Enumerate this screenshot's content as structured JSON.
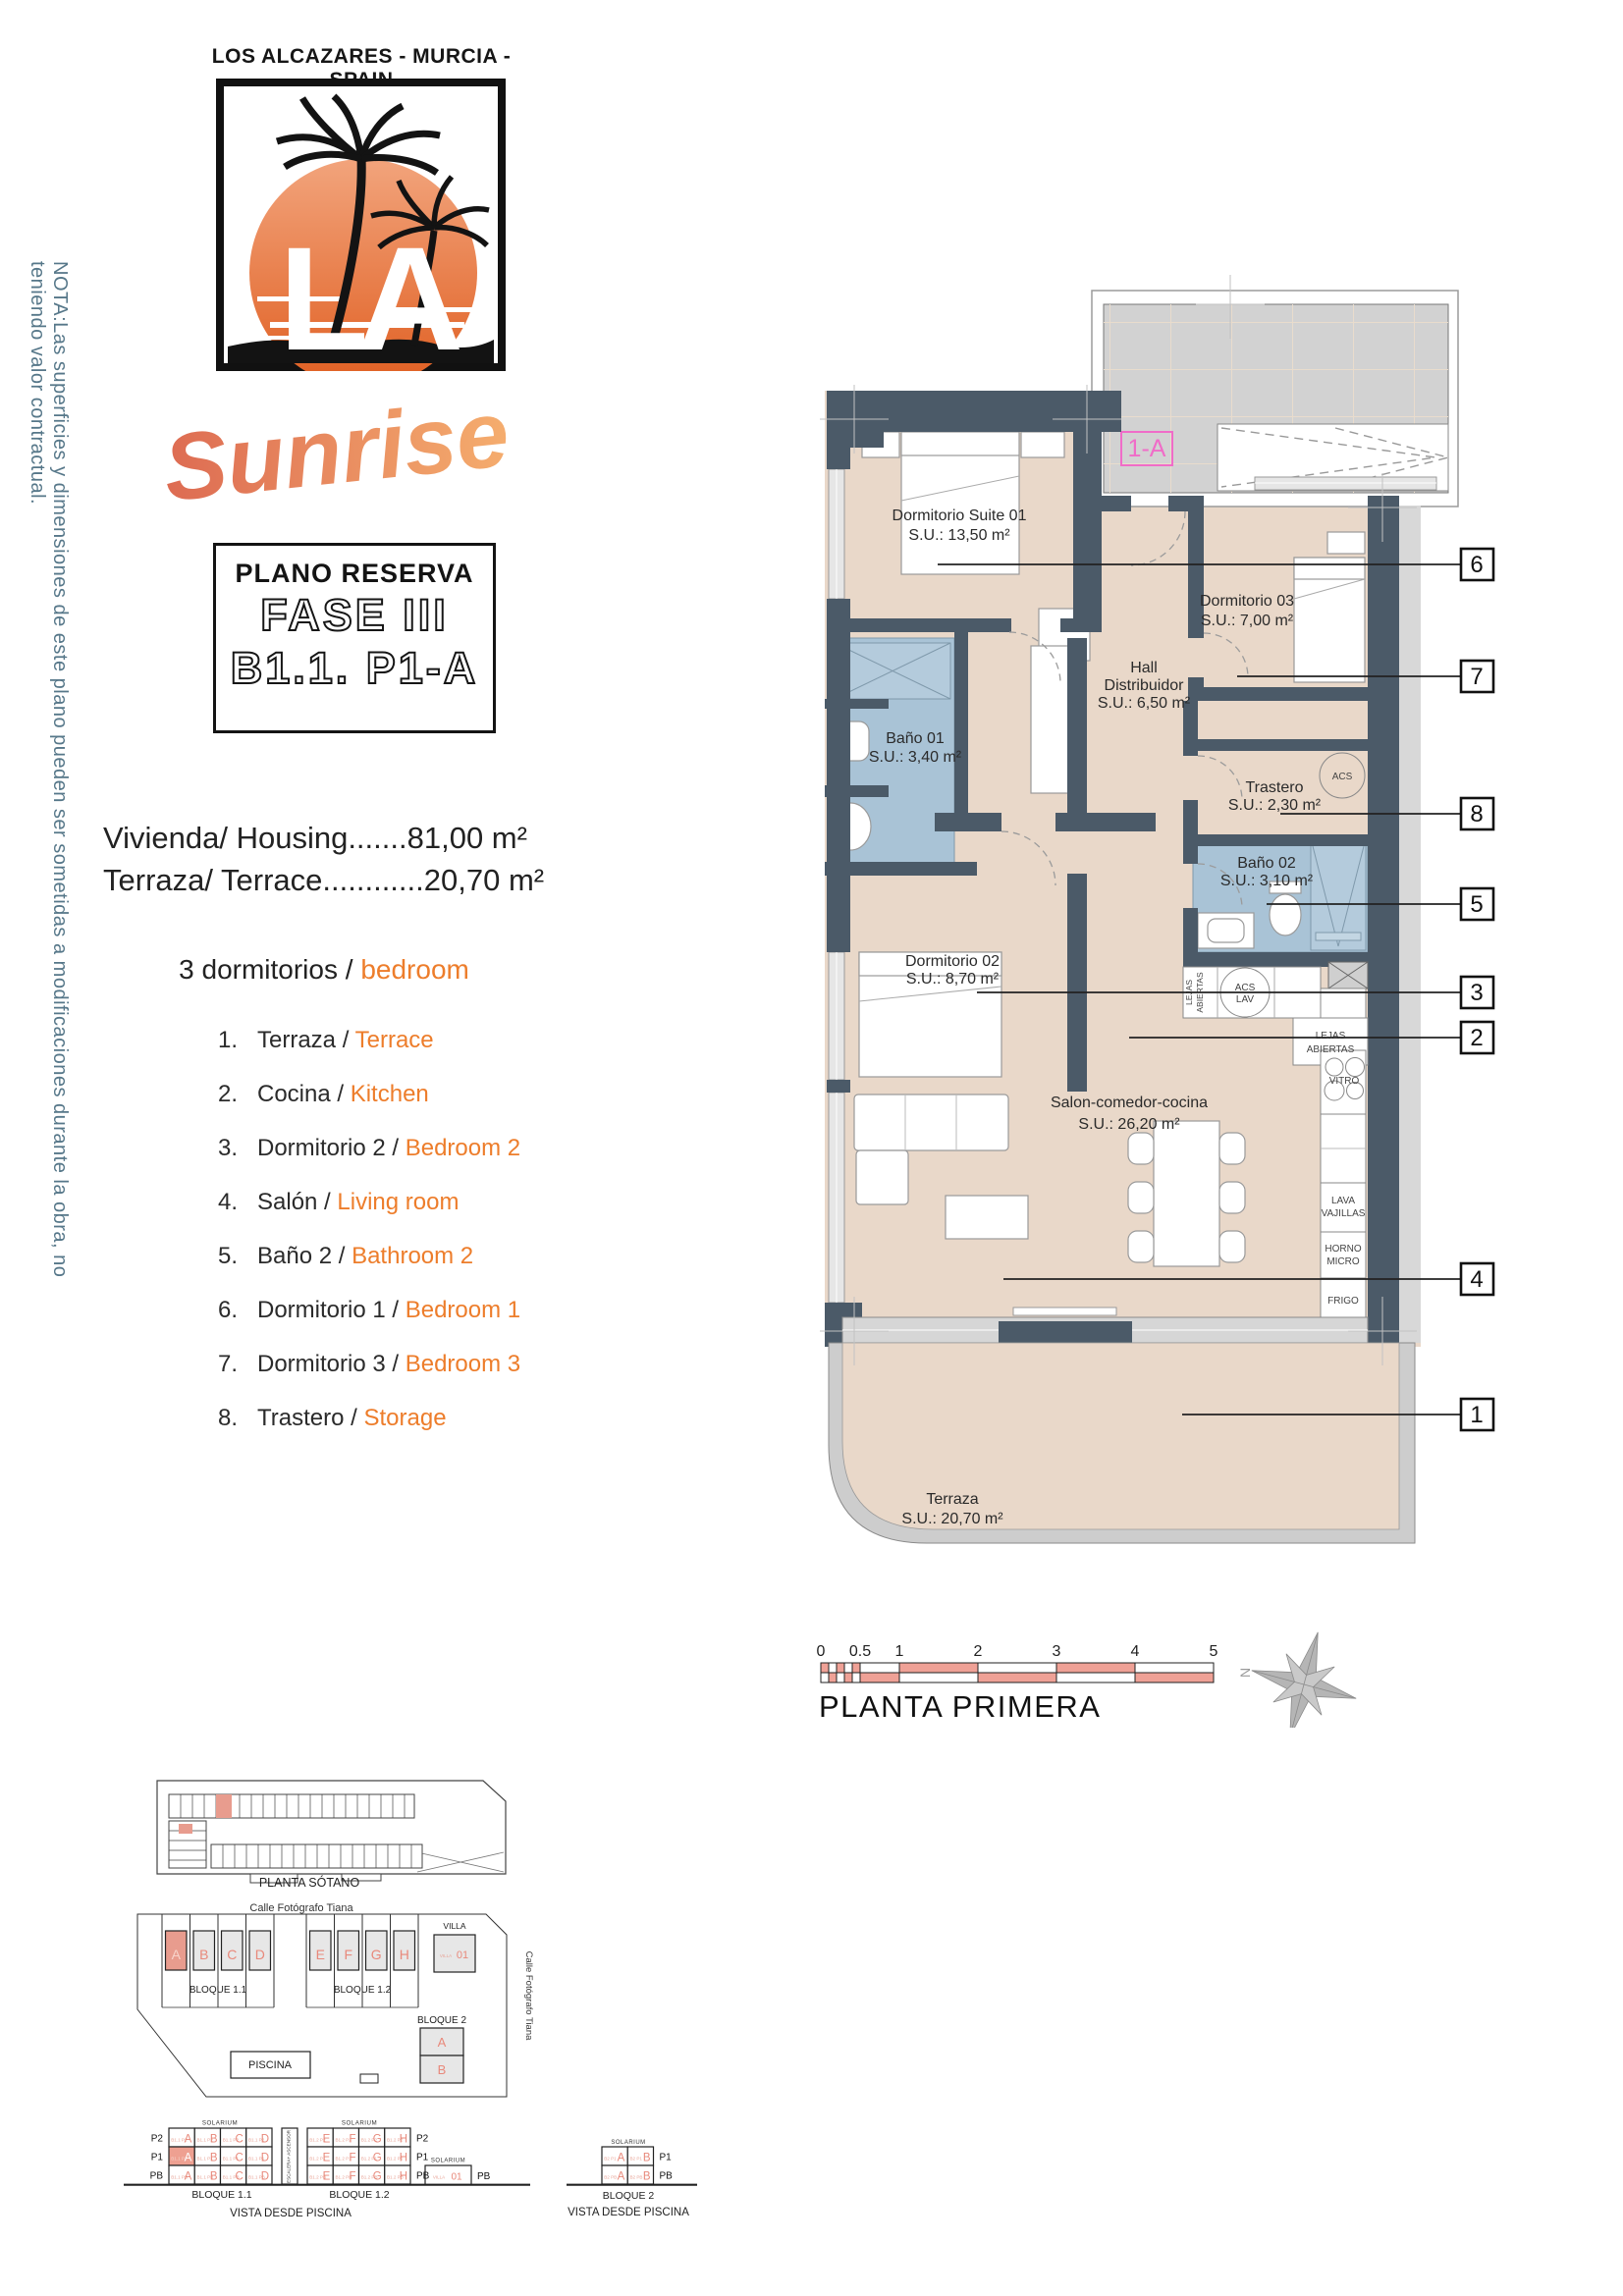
{
  "branding": {
    "location": "LOS ALCAZARES - MURCIA - SPAIN",
    "logo_monogram": "LA",
    "script_name": "Sunrise"
  },
  "side_note": "NOTA:Las superficies y dimensiones de este plano pueden ser sometidas a modificaciones durante la obra, no teniendo valor contractual.",
  "reserve_box": {
    "title": "PLANO RESERVA",
    "phase": "FASE III",
    "unit": "B1.1. P1-A"
  },
  "summary": {
    "housing_line": "Vivienda/ Housing.......81,00 m²",
    "terrace_line": "Terraza/ Terrace............20,70 m²",
    "bedrooms_prefix": "3 dormitorios /",
    "bedrooms_en": "bedroom"
  },
  "legend": {
    "items": [
      {
        "num": "1.",
        "es": "Terraza /",
        "en": "Terrace"
      },
      {
        "num": "2.",
        "es": "Cocina /",
        "en": "Kitchen"
      },
      {
        "num": "3.",
        "es": "Dormitorio 2 /",
        "en": "Bedroom 2"
      },
      {
        "num": "4.",
        "es": "Salón /",
        "en": "Living room"
      },
      {
        "num": "5.",
        "es": "Baño 2 /",
        "en": "Bathroom 2"
      },
      {
        "num": "6.",
        "es": "Dormitorio 1 /",
        "en": "Bedroom 1"
      },
      {
        "num": "7.",
        "es": "Dormitorio 3 /",
        "en": "Bedroom 3"
      },
      {
        "num": "8.",
        "es": "Trastero /",
        "en": "Storage"
      }
    ]
  },
  "plan": {
    "unit_tag": "1-A",
    "rooms": {
      "suite": {
        "name": "Dormitorio Suite 01",
        "area": "S.U.: 13,50 m²"
      },
      "dorm3": {
        "name": "Dormitorio 03",
        "area": "S.U.: 7,00 m²"
      },
      "hall": {
        "name": "Hall",
        "name2": "Distribuidor",
        "area": "S.U.: 6,50 m²"
      },
      "bano1": {
        "name": "Baño 01",
        "area": "S.U.: 3,40 m²"
      },
      "trastero": {
        "name": "Trastero",
        "area": "S.U.: 2,30 m²"
      },
      "bano2": {
        "name": "Baño 02",
        "area": "S.U.: 3,10 m²"
      },
      "dorm2": {
        "name": "Dormitorio 02",
        "area": "S.U.: 8,70 m²"
      },
      "salon": {
        "name": "Salon-comedor-cocina",
        "area": "S.U.: 26,20 m²"
      },
      "terraza": {
        "name": "Terraza",
        "area": "S.U.: 20,70 m²"
      }
    },
    "fixtures": {
      "acs": "ACS",
      "acs2": "ACS",
      "lav": "LAV",
      "lejas_v1": "LEJAS",
      "lejas_v2": "ABIERTAS",
      "lejas1": "LEJAS",
      "lejas2": "ABIERTAS",
      "vitro": "VITRO",
      "lava1": "LAVA",
      "lava2": "VAJILLAS",
      "horno1": "HORNO",
      "horno2": "MICRO",
      "fr": "FRIGO"
    },
    "callouts": {
      "c1": "1",
      "c2": "2",
      "c3": "3",
      "c4": "4",
      "c5": "5",
      "c6": "6",
      "c7": "7",
      "c8": "8"
    },
    "scale_ticks": [
      "0",
      "0.5",
      "1",
      "2",
      "3",
      "4",
      "5"
    ],
    "floor_label": "PLANTA PRIMERA",
    "compass_n": "N"
  },
  "minimaps": {
    "sotano_label": "PLANTA SÓTANO",
    "street": "Calle Fotógrafo Tiana",
    "street_side": "Calle Fotógrafo Tiana",
    "bloque11": "BLOQUE 1.1",
    "bloque12": "BLOQUE 1.2",
    "bloque2": "BLOQUE 2",
    "villa": "VILLA",
    "villa_prefix": "VILLA",
    "villa_num": "01",
    "piscina": "PISCINA",
    "blocks_left": [
      "A",
      "B",
      "C",
      "D"
    ],
    "blocks_right": [
      "E",
      "F",
      "G",
      "H"
    ],
    "bloque2_units": [
      "A",
      "B"
    ],
    "elevation": {
      "floors": [
        "P2",
        "P1",
        "PB"
      ],
      "b2_floors": [
        "P1",
        "PB"
      ],
      "solarium": "SOLARIUM",
      "escalera": "ESCALERA+ ASCENSOR",
      "b11_prefix": "B1.1",
      "b12_prefix": "B1.2",
      "b2_prefix": "B2",
      "villa_pb": "PB",
      "vista": "VISTA DESDE PISCINA"
    }
  },
  "colors": {
    "wall": "#4b5a68",
    "floor": "#e9d8c9",
    "bath": "#a9c3d6",
    "salmon": "#efa196",
    "accent_orange": "#ed7d2b",
    "note_blue": "#567789",
    "pink": "#f06cc8"
  }
}
